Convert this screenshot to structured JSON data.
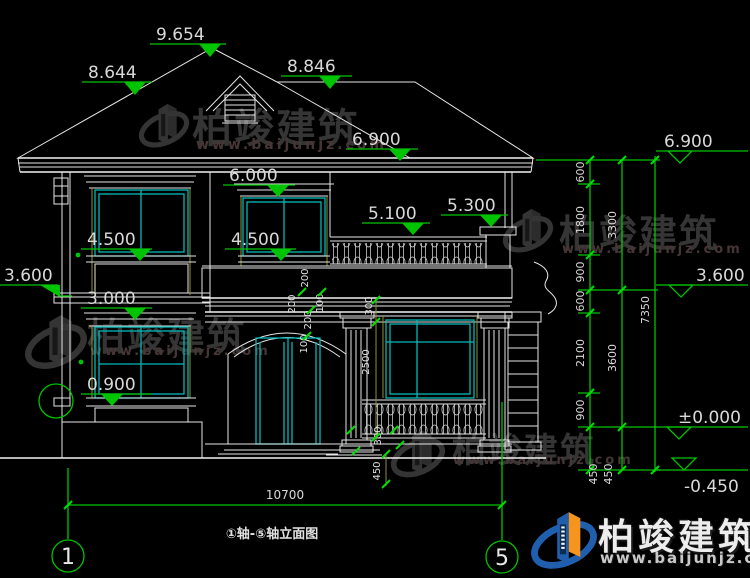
{
  "watermark": {
    "brand": "柏竣建筑",
    "url": "www.baijunjz.com"
  },
  "logo": {
    "brand": "柏竣建筑",
    "url": "www.baijunjz.com"
  },
  "title_block": {
    "drawing_title": "①轴-⑤轴立面图",
    "axis_start": "1",
    "axis_end": "5"
  },
  "levels": {
    "ridge": "9.654",
    "roof_left": "8.644",
    "roof_rear": "8.846",
    "eave": "6.900",
    "f2_window_head": "6.000",
    "balcony_rail": "5.100",
    "balcony_pier": "5.300",
    "f2_sill_left": "4.500",
    "f2_sill_mid": "4.500",
    "f2_floor_left": "3.600",
    "f1_window_head": "3.000",
    "f1_sill": "0.900"
  },
  "levels_right": {
    "eave": "6.900",
    "floor2": "3.600",
    "ground": "±0.000",
    "outdoor": "-0.450"
  },
  "vchain1": [
    "600",
    "1800",
    "900",
    "600",
    "2100",
    "900",
    "450"
  ],
  "vchain1_extra": "450",
  "vchain2": [
    "3300",
    "3600"
  ],
  "vtotal": "7350",
  "htotal": "10700",
  "details": {
    "d200a": "200",
    "d100a": "100",
    "d200b": "200",
    "d100b": "100",
    "d200c": "200",
    "d300a": "300",
    "d2500": "2500",
    "d300b": "300",
    "d450": "450"
  }
}
